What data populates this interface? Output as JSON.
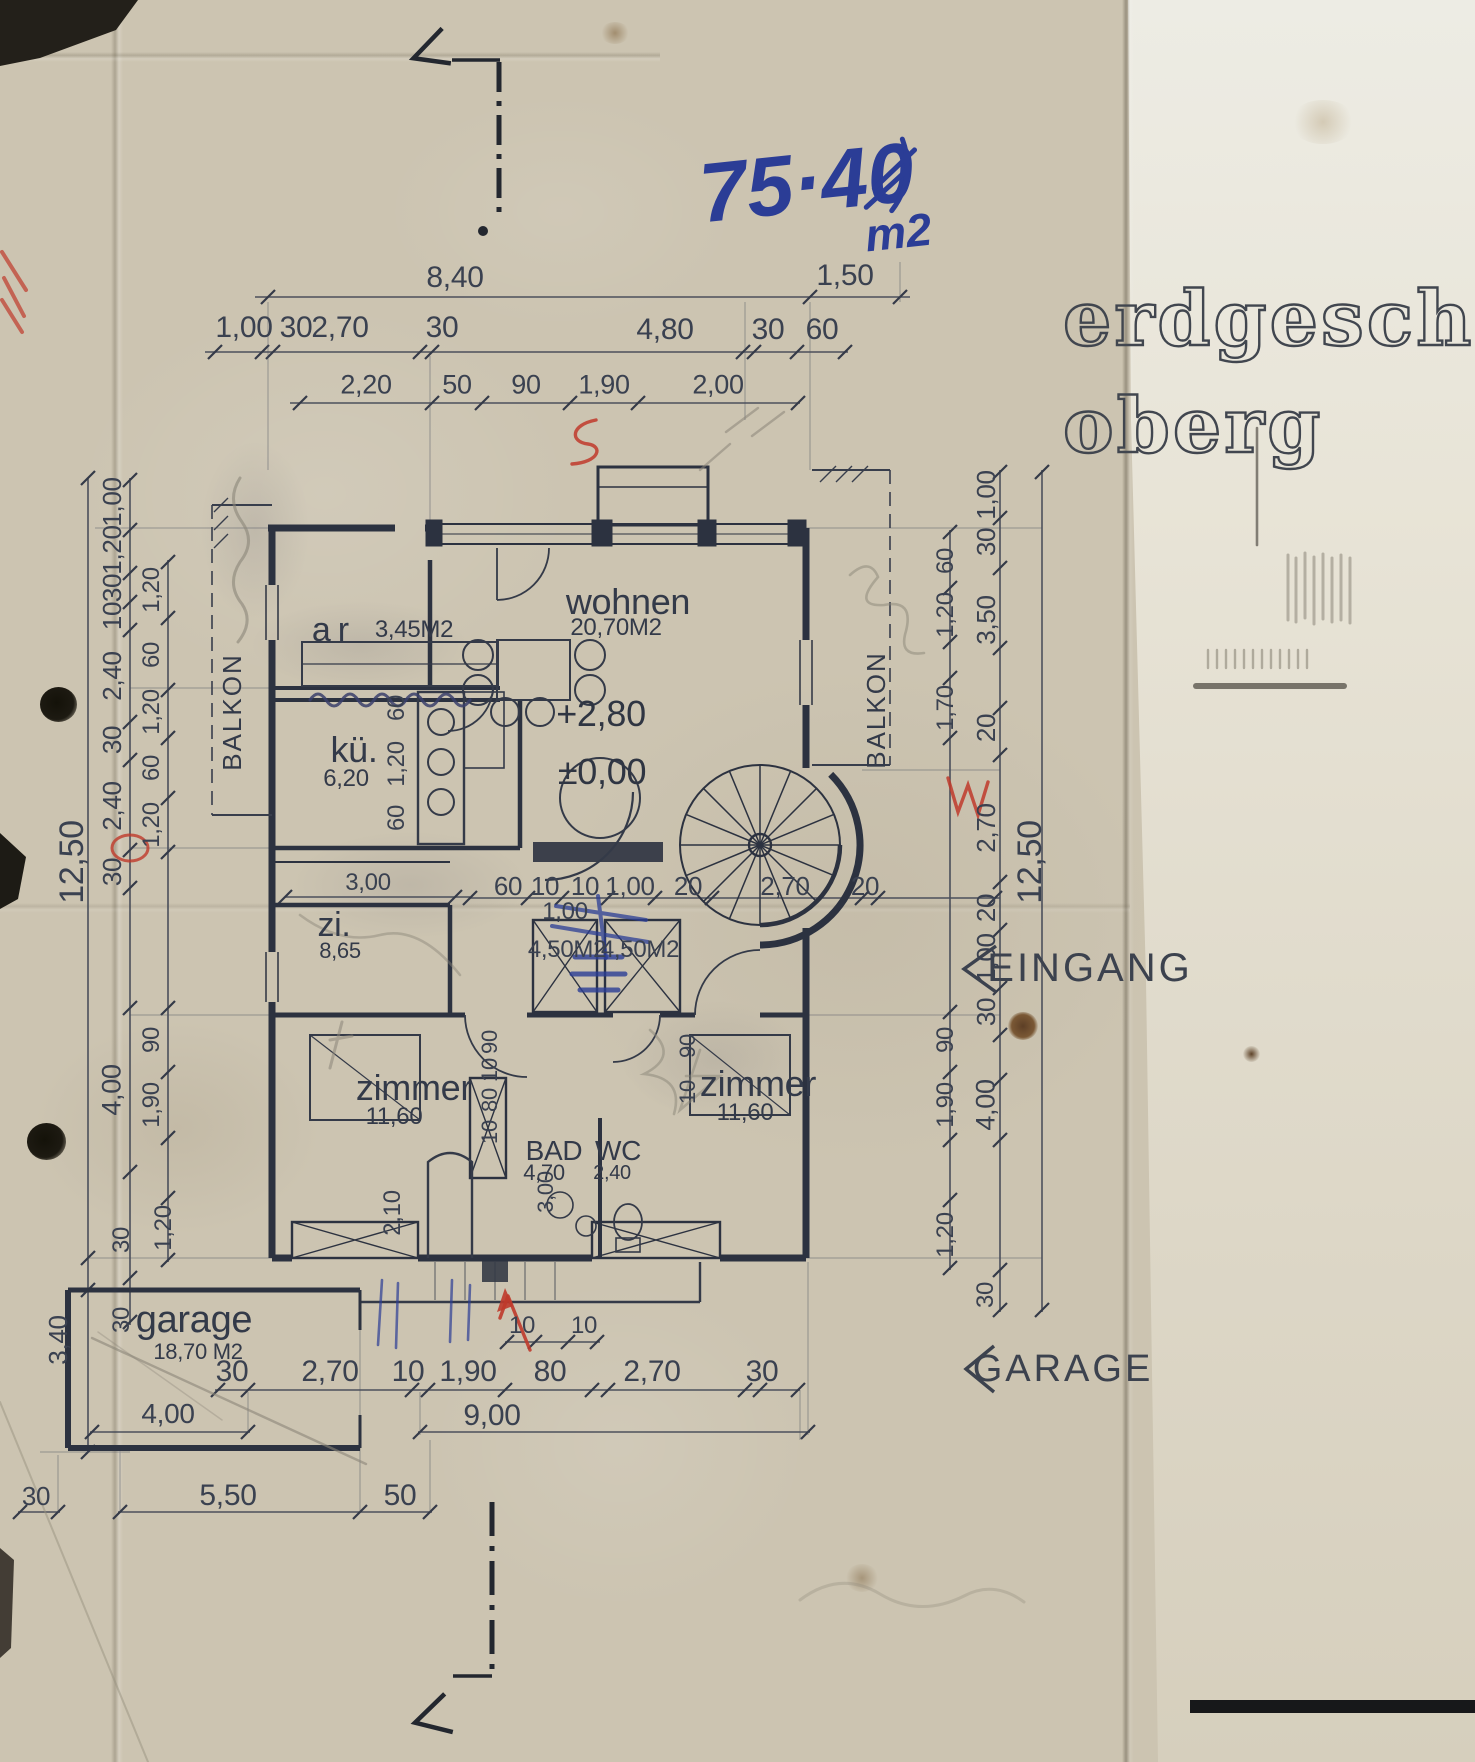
{
  "title": {
    "line1": "erdgesch",
    "line2": "oberg"
  },
  "handwritten": {
    "value": "75·40",
    "unit": "m2"
  },
  "side_labels": {
    "eingang": "EINGANG",
    "garage": "GARAGE"
  },
  "balkon": [
    "BALKON",
    "BALKON"
  ],
  "levels": {
    "upper": "+2,80",
    "ground": "±0,00"
  },
  "rooms": {
    "wohnen": {
      "name": "wohnen",
      "area": "20,70M2"
    },
    "ar": {
      "name": "ar",
      "area": "3,45M2"
    },
    "kueche": {
      "name": "kü.",
      "area": "6,20"
    },
    "zi": {
      "name": "zi.",
      "area": "8,65"
    },
    "zimmer_left": {
      "name": "zimmer",
      "area": "11,60"
    },
    "zimmer_right": {
      "name": "zimmer",
      "area": "11,60"
    },
    "bad": {
      "name": "BAD",
      "area": "4,70"
    },
    "wc": {
      "name": "WC",
      "area": "2,40"
    },
    "garage": {
      "name": "garage",
      "area": "18,70 M2"
    }
  },
  "dims": {
    "top1": [
      "8,40",
      "1,50"
    ],
    "top2": [
      "1,00",
      "30",
      "2,70",
      "30",
      "4,80",
      "30",
      "60"
    ],
    "top3": [
      "2,20",
      "50",
      "90",
      "1,90",
      "2,00"
    ],
    "mid": [
      "60",
      "10",
      "10",
      "1,00",
      "20",
      "2,70",
      "20"
    ],
    "hall": {
      "width": "1,00",
      "left_area": "4,50M2",
      "right_area": "4,50M2"
    },
    "zi_width": "3,00",
    "kue": [
      "60",
      "1,20",
      "60"
    ],
    "left_outer": [
      "1,00",
      "1,20",
      "30",
      "10",
      "2,40",
      "30",
      "2,40",
      "30"
    ],
    "left_inner": [
      "1,20",
      "60",
      "1,20",
      "60",
      "1,20"
    ],
    "left_lower": [
      "90",
      "4,00",
      "1,90",
      "1,20",
      "30",
      "30"
    ],
    "left_garage": "3,40",
    "left_total": "12,50",
    "right_outer": [
      "1,00",
      "30",
      "3,50",
      "20",
      "2,70",
      "20",
      "1,00",
      "30"
    ],
    "right_inner": [
      "60",
      "1,20",
      "1,70",
      "90",
      "1,90",
      "1,20"
    ],
    "right_lower": [
      "4,00",
      "30"
    ],
    "right_total": "12,50",
    "pier": [
      "90",
      "10",
      "80",
      "10"
    ],
    "right_room": [
      "90",
      "10"
    ],
    "bath": [
      "2,10",
      "3,00"
    ],
    "bottom_small": [
      "10",
      "10"
    ],
    "bottom1": [
      "30",
      "2,70",
      "10",
      "1,90",
      "80",
      "2,70",
      "30"
    ],
    "bottom2": [
      "4,00",
      "9,00"
    ],
    "bottom3": [
      "30",
      "5,50",
      "50"
    ]
  },
  "colors": {
    "ink": "#2c3240",
    "pen_blue": "#2b3d96",
    "red": "#bf3a2b",
    "pencil": "#8a8578",
    "paper": "#ccc4b1",
    "paper_light": "#e7e3d6"
  }
}
